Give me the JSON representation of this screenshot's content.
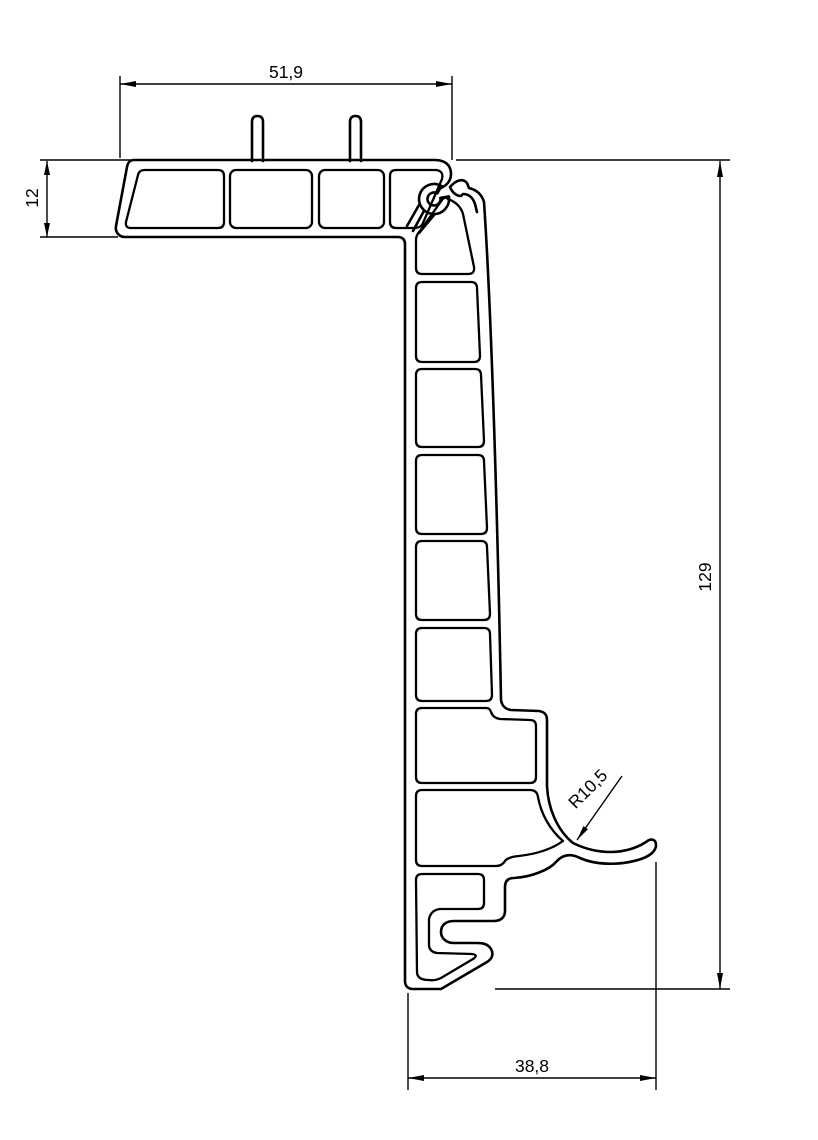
{
  "drawing": {
    "type": "technical-profile-cross-section",
    "line_color": "#000000",
    "background_color": "#ffffff",
    "dimensions": {
      "top_width": "51,9",
      "left_height": "12",
      "right_height": "129",
      "bottom_width": "38,8",
      "radius": "R10,5"
    }
  }
}
